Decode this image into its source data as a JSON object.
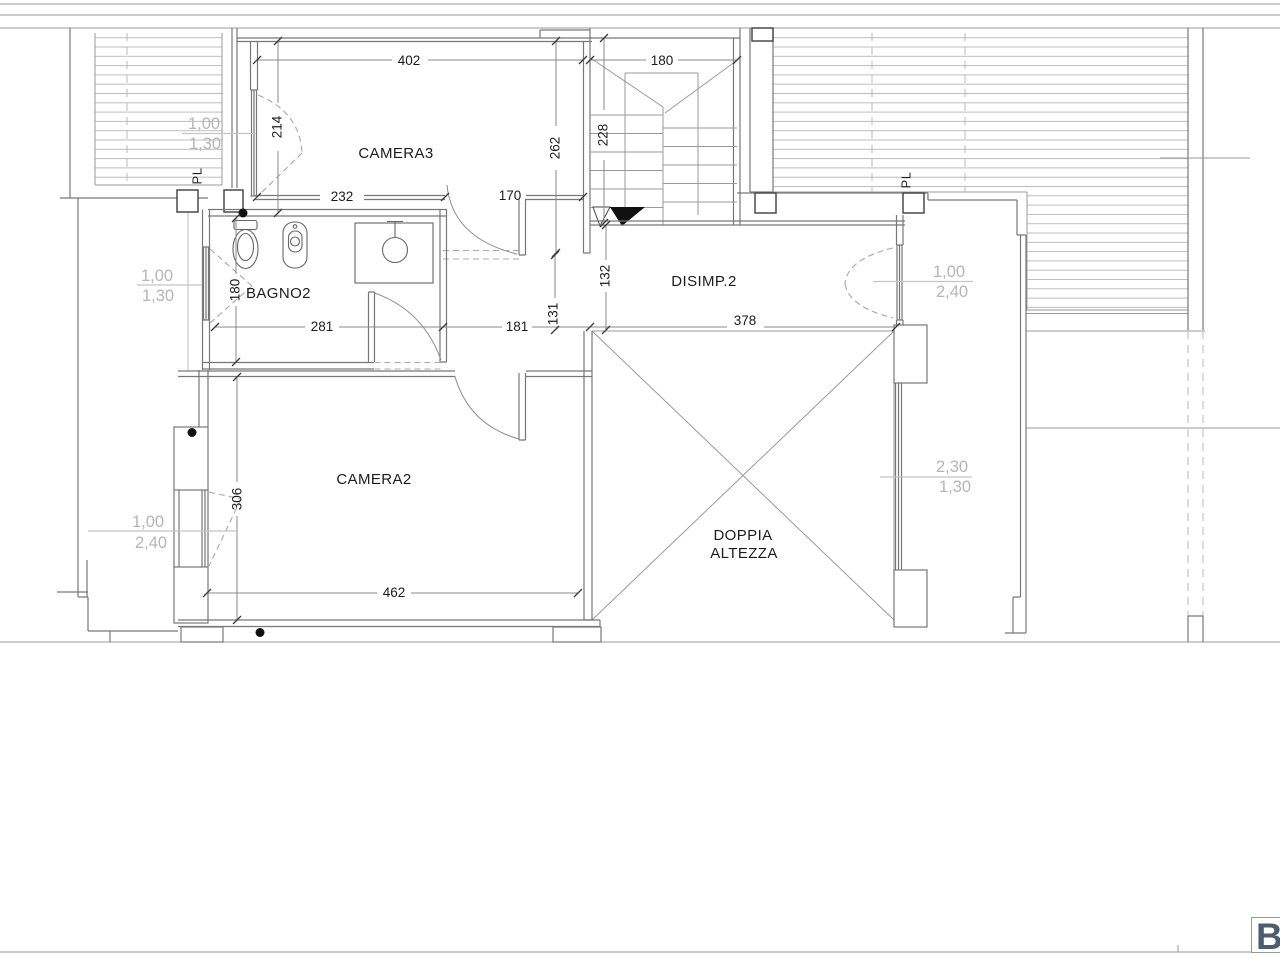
{
  "rooms": {
    "camera3": "CAMERA3",
    "bagno2": "BAGNO2",
    "disimp2": "DISIMP.2",
    "camera2": "CAMERA2",
    "doppia_line1": "DOPPIA",
    "doppia_line2": "ALTEZZA"
  },
  "dims": {
    "camera3_width": "402",
    "stair_width": "180",
    "camera3_left": "214",
    "camera3_depth": "262",
    "camera3_wall": "232",
    "camera3_door": "170",
    "stair_depth": "228",
    "bagno2_depth": "180",
    "bagno2_width": "281",
    "hall_width": "181",
    "hall_depth": "131",
    "disimp2_width": "132",
    "doppia_width": "378",
    "camera2_depth": "306",
    "camera2_width": "462"
  },
  "windows": {
    "terrace_left": {
      "w": "1,00",
      "h": "1,30"
    },
    "bagno2_left": {
      "w": "1,00",
      "h": "1,30"
    },
    "camera2_left": {
      "w": "1,00",
      "h": "2,40"
    },
    "disimp2_right": {
      "w": "1,00",
      "h": "2,40"
    },
    "doppia_right": {
      "w": "2,30",
      "h": "1,30"
    }
  },
  "pillars": {
    "left_label": "PL",
    "right_label": "PL"
  },
  "logo": {
    "letter": "B"
  },
  "colors": {
    "wall_line": "#777777",
    "hatch_line": "#bcbcbc",
    "note_text": "#b5b5b5",
    "logo_blue": "#4d5d70"
  }
}
